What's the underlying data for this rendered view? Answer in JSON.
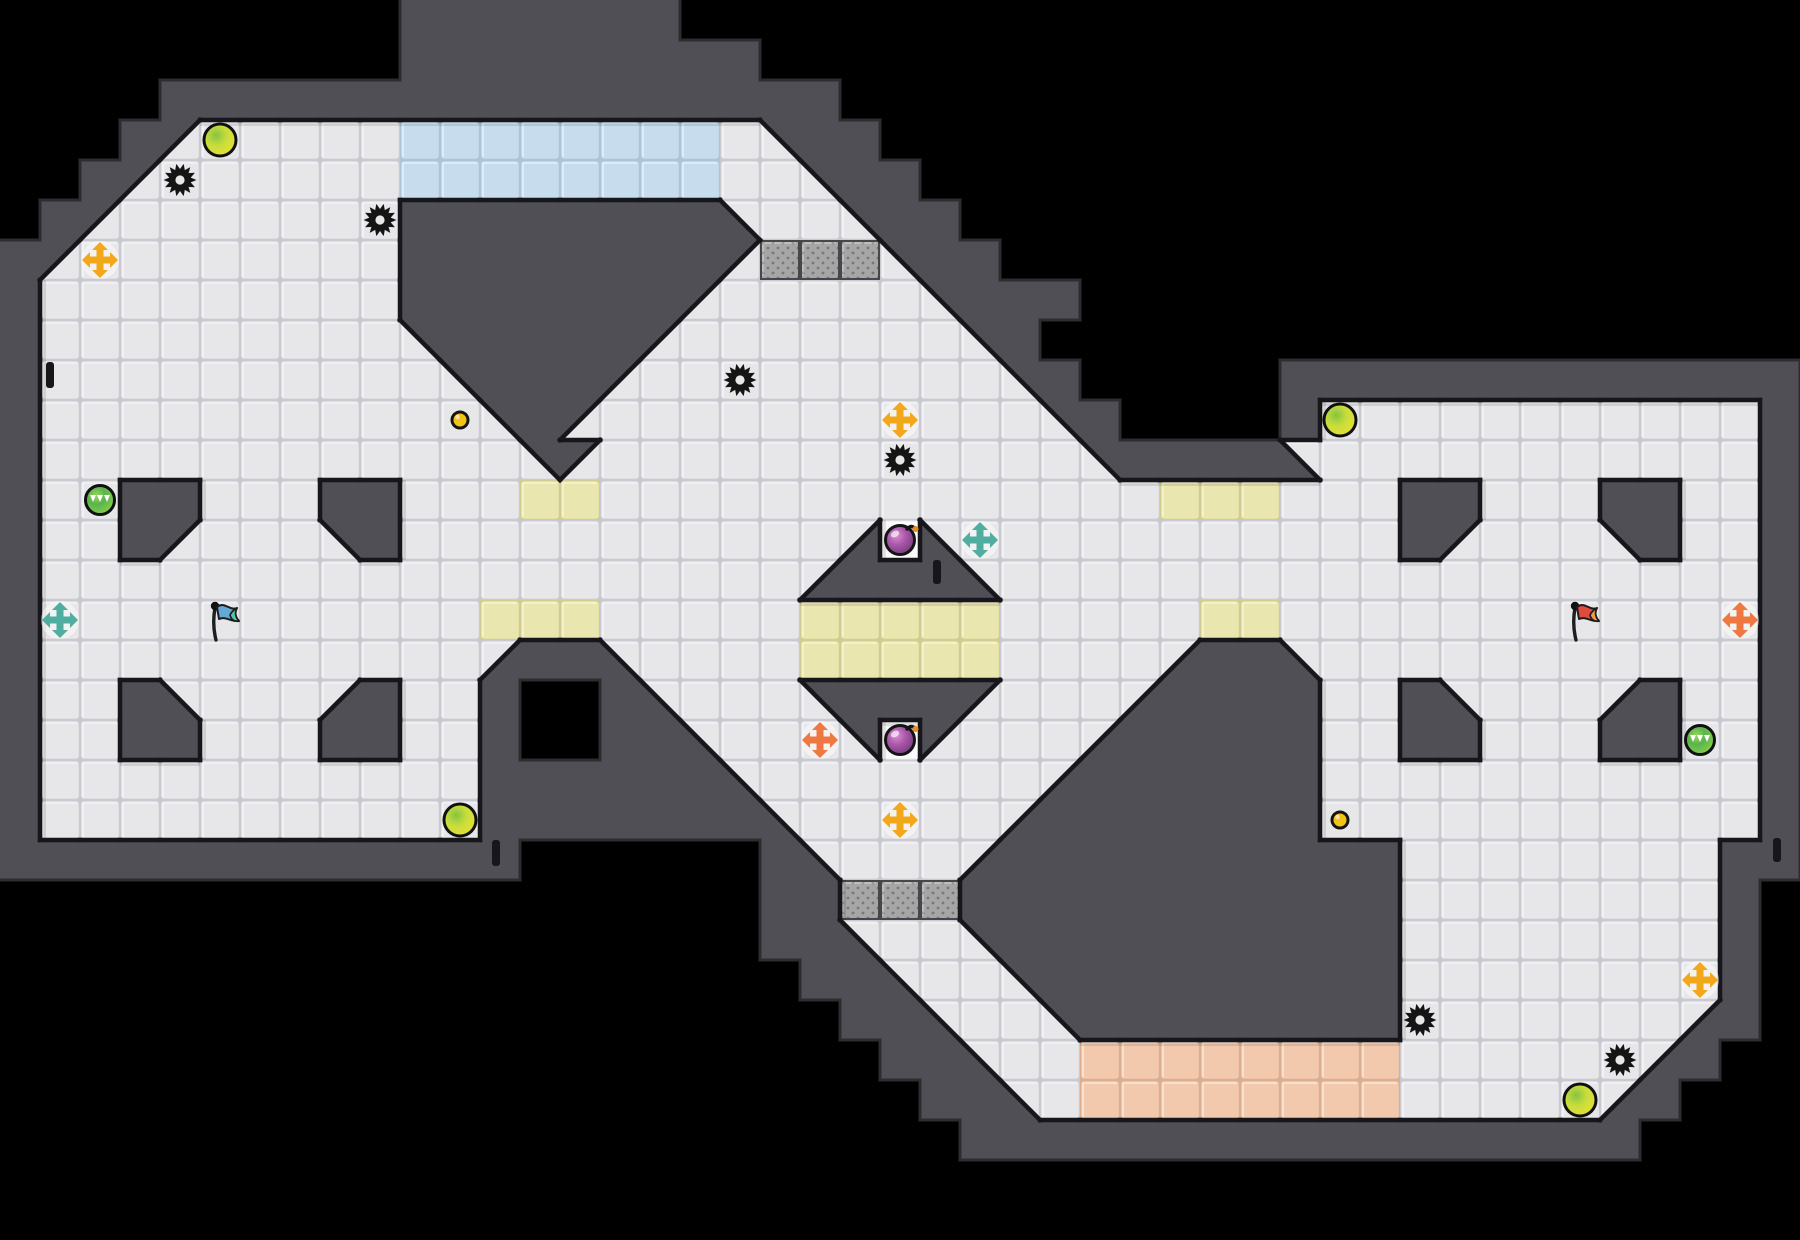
{
  "canvas": {
    "width": 1800,
    "height": 1240,
    "tile_size": 40,
    "background": "#000000"
  },
  "palette": {
    "wall": "#4f4f55",
    "wall_outline_inner": "#17171b",
    "wall_outline_outer": "#2c2c31",
    "floor": "#e7e7ea",
    "floor_seam": "#c9c9d1",
    "floor_highlight": "rgba(255,255,255,0.55)",
    "alcove": "#fafafb",
    "alcove_seam": "#d8d8de",
    "blue_tile": "#c7dcec",
    "blue_seam": "#a9c6da",
    "yellow_tile": "#eae6af",
    "yellow_seam": "#d2cc8d",
    "orange_tile": "#f3c9ad",
    "orange_seam": "#dcae8e",
    "gate_base": "#a6a6a6",
    "gate_dot": "#787878",
    "gate_border": "#47474b",
    "shadow": "rgba(0,0,0,0.10)",
    "spike": "#141414",
    "gold_dot": "#f3c117",
    "boost_yellow": "#f3a81c",
    "boost_teal": "#4fae9f",
    "boost_orange": "#ef7840",
    "boost_halo": "rgba(255,255,255,0.45)",
    "bomb_dark": "#6d3a74",
    "bomb_mid": "#a855a8",
    "bomb_light": "#d98ed2",
    "bomb_fuse_tip": "#f08a1c",
    "ball_edge": "#dedf35",
    "ball_center": "#86c441",
    "green_center": "#59b54c",
    "green_rim": "#c9d93f",
    "flag_blue_main": "#64a8d8",
    "flag_blue_tail": "#4fc7a8",
    "flag_red_main": "#e04b3e",
    "flag_red_tail": "#f09d3a",
    "flag_pole": "#1e1e1e"
  },
  "map": {
    "legend": {
      "#": "outside-black",
      "W": "wall",
      ".": "floor",
      "A": "bomb-alcove-floor",
      "B": "blue-team-tile",
      "Y": "yellow-tile",
      "O": "orange-team-tile",
      "G": "gate-tile",
      "q": "diag-wall-top-left",
      "e": "diag-wall-top-right",
      "z": "diag-wall-bottom-left",
      "c": "diag-wall-bottom-right"
    },
    "rows": [
      "##########WWWWWWW############################",
      "##########WWWWWWWWW##########################",
      "####WWWWWWWWWWWWWWWWW########################",
      "###Wq.....BBBBBBBB.eWW#######################",
      "##Wq......BBBBBBBB..eWW######################",
      "#Wq.......WWWWWWWWz..eWW#####################",
      "Wq........WWWWWWWWqGGGeWW####################",
      "W.........WWWWWWWq.....eWWW##################",
      "W.........eWWWWWq.......eW###################",
      "W..........eWWWq.........eW#####WWWWWWWWWWWWW",
      "W...........eWq...........eW####W...........W",
      "W............eq............eWWWWz...........W",
      "W..WW...WW...YY..............YYY...WW...WW..W",
      "W..Wq...eW...........cAz...........Wq...eW..W",
      "W...................cWWWz...................W",
      "W...........YYY.....YYYYY.....YY............W",
      "W...........cWWz....YYYYY....cWWz...........W",
      "W..Wz...cW..W##Wz...eWWWq...cWWWW..Wz...cW..W",
      "W..WW...WW..W##WWz...eAq...cWWWWW..WW...WW..W",
      "W...........WWWWWWz.......cWWWWWW...........W",
      "W...........WWWWWWWz.....cWWWWWWW...........W",
      "WWWWWWWWWWWWW######Wz...cWWWWWWWWWW........WW",
      "###################WWGGGWWWWWWWWWWW........W#",
      "###################WWz..eWWWWWWWWWW........W#",
      "####################WWz..eWWWWWWWWW........W#",
      "#####################WWz..eWWWWWWWW.......cW#",
      "######################WWz..OOOOOOOO......cW##",
      "#######################WWz.OOOOOOOO.....cW###",
      "########################WWWWWWWWWWWWWWWWW####",
      "#############################################",
      "#############################################"
    ]
  },
  "items": {
    "spikes": [
      [
        4,
        4
      ],
      [
        9,
        5
      ],
      [
        18,
        9
      ],
      [
        22,
        11
      ],
      [
        35,
        25
      ],
      [
        40,
        26
      ]
    ],
    "powerups_yellow": [
      [
        5,
        3
      ],
      [
        11,
        20
      ],
      [
        33,
        10
      ],
      [
        39,
        27
      ]
    ],
    "powerups_green": [
      [
        2,
        12
      ],
      [
        42,
        18
      ]
    ],
    "gold_dots": [
      [
        11,
        10
      ],
      [
        33,
        20
      ]
    ],
    "boosts": [
      {
        "pos": [
          2,
          6
        ],
        "color": "yellow"
      },
      {
        "pos": [
          22,
          10
        ],
        "color": "yellow"
      },
      {
        "pos": [
          22,
          20
        ],
        "color": "yellow"
      },
      {
        "pos": [
          42,
          24
        ],
        "color": "yellow"
      },
      {
        "pos": [
          1,
          15
        ],
        "color": "teal"
      },
      {
        "pos": [
          24,
          13
        ],
        "color": "teal"
      },
      {
        "pos": [
          20,
          18
        ],
        "color": "orange"
      },
      {
        "pos": [
          43,
          15
        ],
        "color": "orange"
      }
    ],
    "bombs": [
      [
        22,
        13
      ],
      [
        22,
        18
      ]
    ],
    "flags": [
      {
        "pos": [
          5,
          15
        ],
        "team": "blue"
      },
      {
        "pos": [
          39,
          15
        ],
        "team": "red"
      }
    ],
    "wall_ticks": [
      {
        "x": 46,
        "y": 362,
        "w": 8,
        "h": 26
      },
      {
        "x": 492,
        "y": 840,
        "w": 8,
        "h": 26
      },
      {
        "x": 933,
        "y": 560,
        "w": 8,
        "h": 24
      },
      {
        "x": 1773,
        "y": 838,
        "w": 8,
        "h": 24
      }
    ]
  }
}
